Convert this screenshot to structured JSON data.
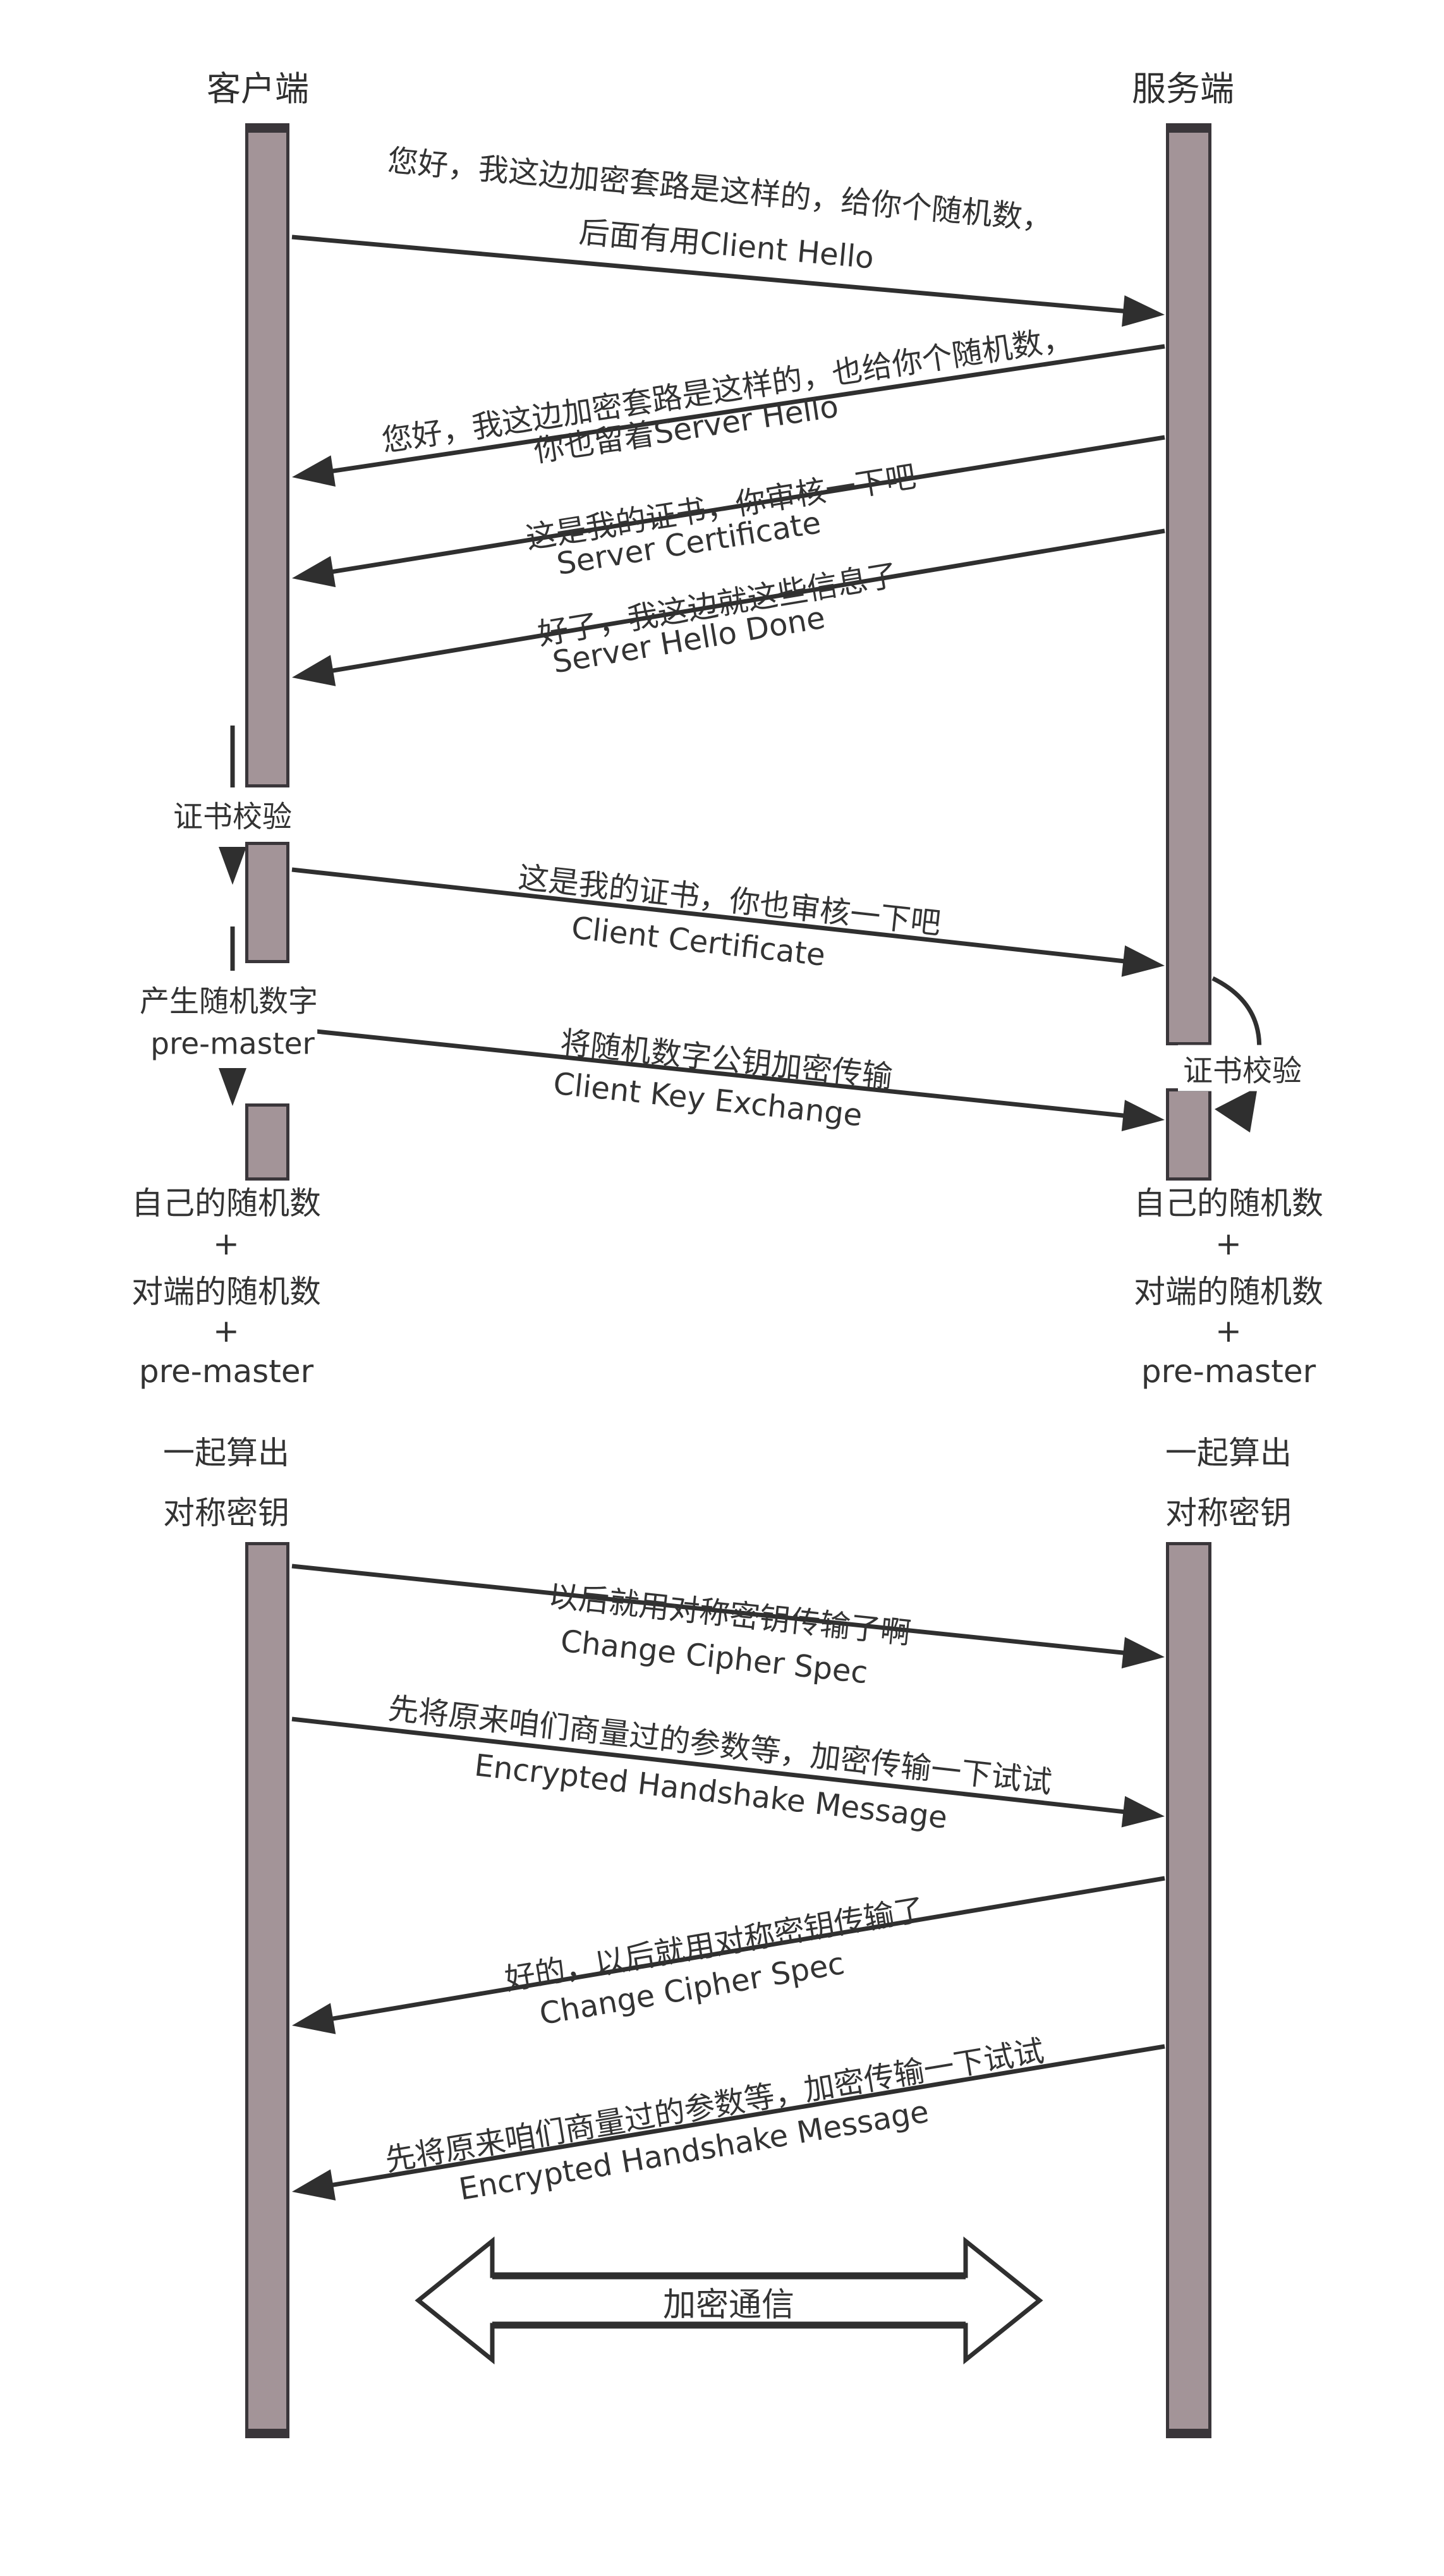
{
  "actors": {
    "client_label": "客户端",
    "server_label": "服务端"
  },
  "messages": [
    {
      "id": "client-hello",
      "direction": "right",
      "line1": "您好，我这边加密套路是这样的，给你个随机数，",
      "line2": "后面有用Client Hello"
    },
    {
      "id": "server-hello",
      "direction": "left",
      "line1": "您好，我这边加密套路是这样的，也给你个随机数，",
      "line2": "你也留着Server Hello"
    },
    {
      "id": "server-certificate",
      "direction": "left",
      "line1": "这是我的证书，你审核一下吧",
      "line2": "Server Certificate"
    },
    {
      "id": "server-hello-done",
      "direction": "left",
      "line1": "好了，我这边就这些信息了",
      "line2": "Server Hello Done"
    },
    {
      "id": "client-certificate",
      "direction": "right",
      "line1": "这是我的证书，你也审核一下吧",
      "line2": "Client Certificate"
    },
    {
      "id": "client-key-exchange",
      "direction": "right",
      "line1": "将随机数字公钥加密传输",
      "line2": "Client Key Exchange"
    },
    {
      "id": "change-cipher-spec-client",
      "direction": "right",
      "line1": "以后就用对称密钥传输了啊",
      "line2": "Change Cipher Spec"
    },
    {
      "id": "encrypted-handshake-client",
      "direction": "right",
      "line1": "先将原来咱们商量过的参数等，加密传输一下试试",
      "line2": "Encrypted Handshake Message"
    },
    {
      "id": "change-cipher-spec-server",
      "direction": "left",
      "line1": "好的，以后就用对称密钥传输了",
      "line2": "Change Cipher Spec"
    },
    {
      "id": "encrypted-handshake-server",
      "direction": "left",
      "line1": "先将原来咱们商量过的参数等，加密传输一下试试",
      "line2": "Encrypted Handshake Message"
    }
  ],
  "client_annotations": {
    "verify": "证书校验",
    "generate_line1": "产生随机数字",
    "generate_line2": "pre-master"
  },
  "server_annotations": {
    "verify": "证书校验"
  },
  "key_derivation": [
    "自己的随机数",
    "+",
    "对端的随机数",
    "+",
    "pre-master",
    "一起算出",
    "对称密钥"
  ],
  "banner": "加密通信",
  "colors": {
    "lifeline_fill": "#a39498",
    "lifeline_border": "#3a363a",
    "arrow": "#2f2f2f",
    "text": "#333333"
  }
}
